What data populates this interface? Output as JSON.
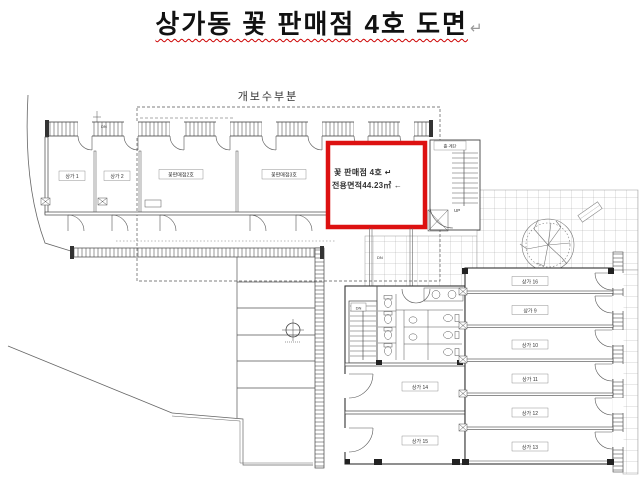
{
  "title": {
    "text": "상가동 꽃 판매점 4호 도면",
    "paragraph_mark": "↵"
  },
  "plan": {
    "renovation_label": "개보수부분",
    "annotations": {
      "up": "UP",
      "dn": "DN"
    },
    "highlight_unit": {
      "line1": "꽃 판매점 4호 ↵",
      "line2": "전용면적44.23㎡ ←",
      "box_color": "#dd1111",
      "text_color": "#2a35b8"
    },
    "upper_rooms": [
      {
        "label": "상가 1"
      },
      {
        "label": "상가 2"
      },
      {
        "label": "꽃판매점2호"
      },
      {
        "label": "꽃판매점3호"
      }
    ],
    "stair_annex_label": "홀·계단",
    "lower_rooms_left": [
      {
        "label": "상가 14"
      },
      {
        "label": "상가 15"
      }
    ],
    "lower_rooms_right": [
      {
        "label": "상가 16"
      },
      {
        "label": "상가 9"
      },
      {
        "label": "상가 10"
      },
      {
        "label": "상가 11"
      },
      {
        "label": "상가 12"
      },
      {
        "label": "상가 13"
      }
    ],
    "symbols": {
      "tree": "tree-icon",
      "benchmark": "crosshair-benchmark-icon",
      "bench": "planter-bench"
    },
    "line_color": "#444444"
  }
}
